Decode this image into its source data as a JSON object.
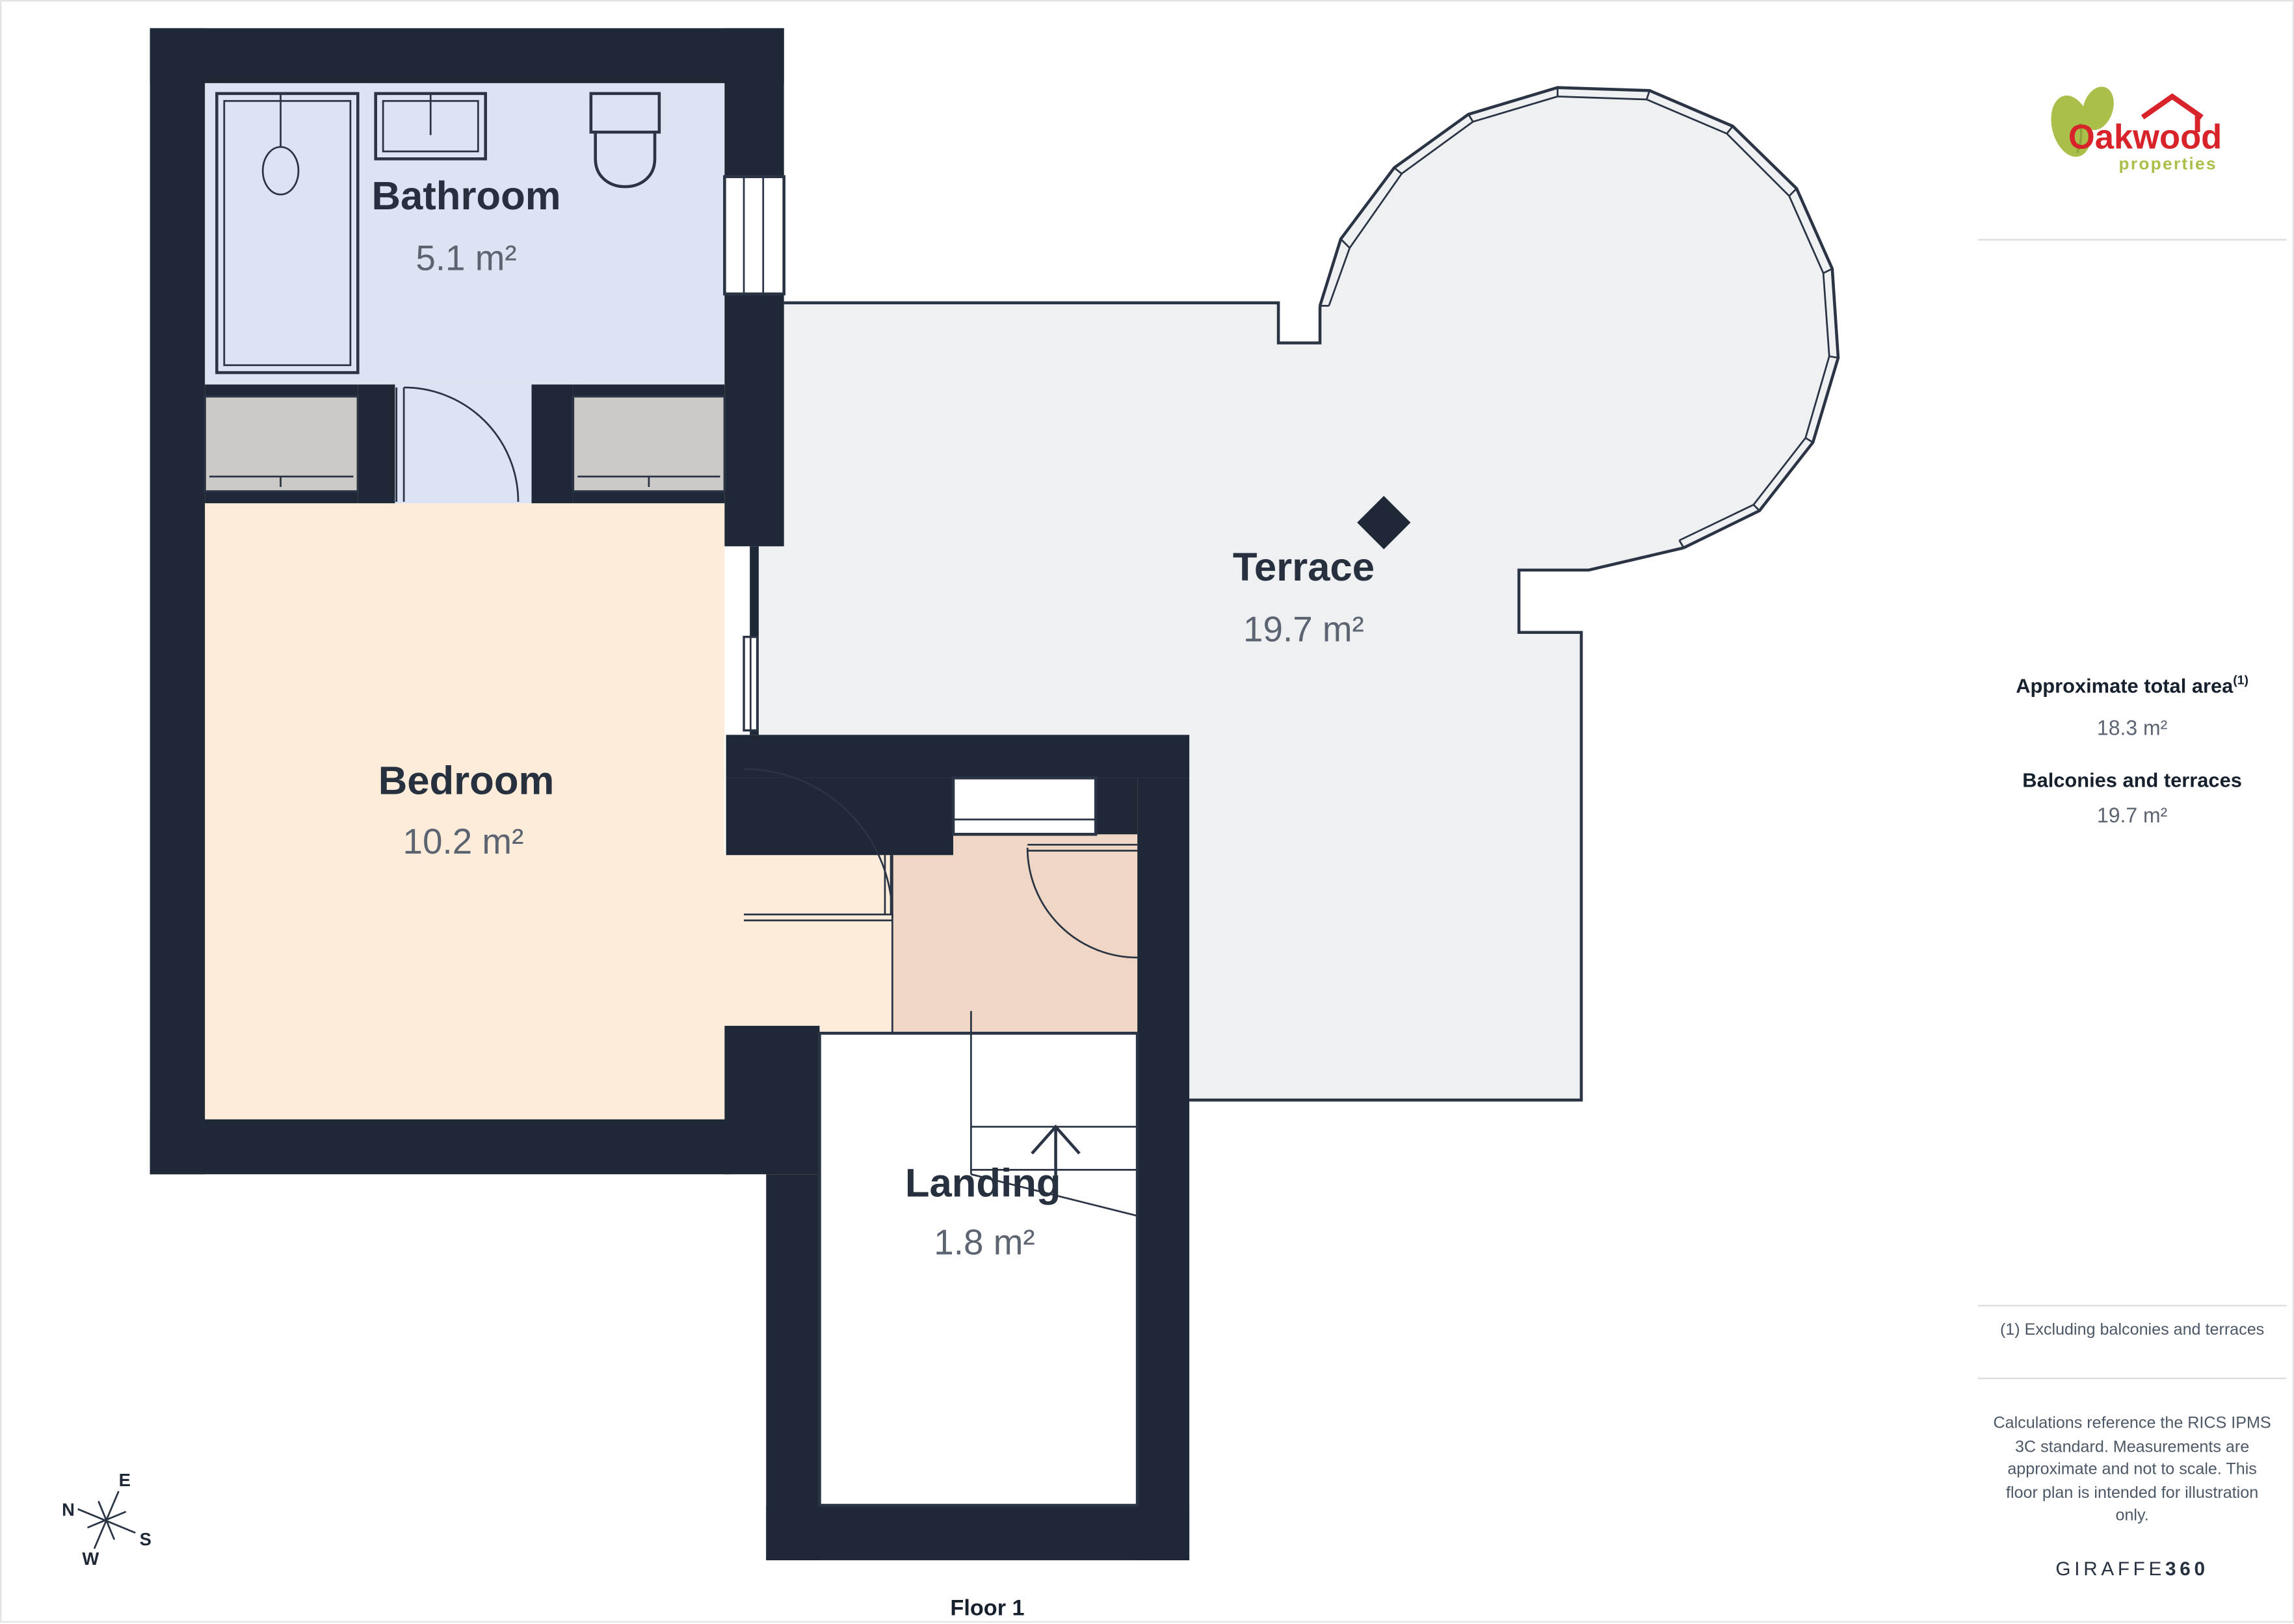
{
  "branding": {
    "logo_primary": "Oakwood",
    "logo_secondary": "properties"
  },
  "floor": {
    "label": "Floor 1"
  },
  "rooms": [
    {
      "id": "bathroom",
      "name": "Bathroom",
      "area": "5.1 m²"
    },
    {
      "id": "bedroom",
      "name": "Bedroom",
      "area": "10.2 m²"
    },
    {
      "id": "terrace",
      "name": "Terrace",
      "area": "19.7 m²"
    },
    {
      "id": "landing",
      "name": "Landing",
      "area": "1.8 m²"
    }
  ],
  "compass": {
    "n": "N",
    "e": "E",
    "s": "S",
    "w": "W"
  },
  "sidebar": {
    "total_area_label": "Approximate total area",
    "total_area_marker": "(1)",
    "total_area_value": "18.3 m²",
    "balconies_label": "Balconies and terraces",
    "balconies_value": "19.7 m²",
    "footnote": "(1) Excluding balconies and terraces",
    "disclaimer_lines": [
      "Calculations reference the RICS IPMS",
      "3C standard. Measurements are",
      "approximate and not to scale. This",
      "floor plan is intended for illustration",
      "only."
    ],
    "brand_footer": {
      "name": "GIRAFFE",
      "suffix": "360"
    }
  },
  "colors": {
    "wall": "#1e2836",
    "outline": "#2a3444",
    "bath": "#dce3f2",
    "bed": "#fdecd9",
    "landing": "#f0d7c5",
    "terrace": "#eef0f2",
    "wardrobe": "#cbcac7",
    "labelDark": "#26303f",
    "labelGray": "#5b6470",
    "textDark": "#17212e",
    "textGray": "#4d5866",
    "rule": "#dcdde0",
    "pageBorder": "#e3e3e3",
    "logoRed": "#d8232a",
    "logoGreen": "#a9bf4a"
  }
}
